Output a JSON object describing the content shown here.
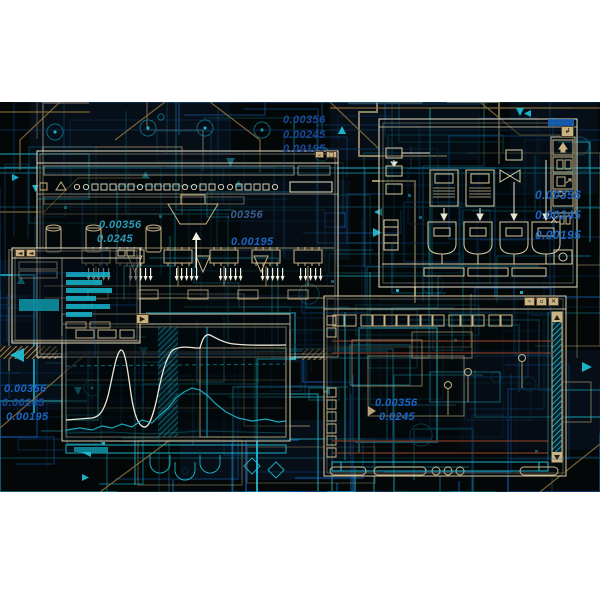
{
  "palette": {
    "background": "#030707",
    "page_margin": "#ffffff",
    "cyan": "#1ec3da",
    "teal": "#0f7f92",
    "blue": "#1565c0",
    "navy": "#0d3f7a",
    "tan": "#c9b385",
    "cream": "#e8e0c4",
    "white_trace": "#eee8d8",
    "maroon": "#7c3a24",
    "text_blue": "#1a66c4",
    "text_dark_blue": "#1b4a9b",
    "text_teal": "#2a9cb4"
  },
  "icons": {
    "minimize": "–",
    "maximize": "▫",
    "restore": "❐",
    "close": "✕",
    "return": "↲",
    "back": "◄",
    "play": "▶"
  },
  "labels": {
    "top": [
      "0.00356",
      "0.00245",
      "0.00195"
    ],
    "right": [
      "0.00356",
      "0.00245",
      "0.00195"
    ],
    "mid_left": [
      "0.00356",
      "0.0245"
    ],
    "mid_center": [
      ".00356",
      "0.00195"
    ],
    "bottom_left": [
      "0.00356",
      "0.00245",
      "0.00195"
    ],
    "lower_right": [
      "0.00356",
      "0.0245"
    ]
  }
}
